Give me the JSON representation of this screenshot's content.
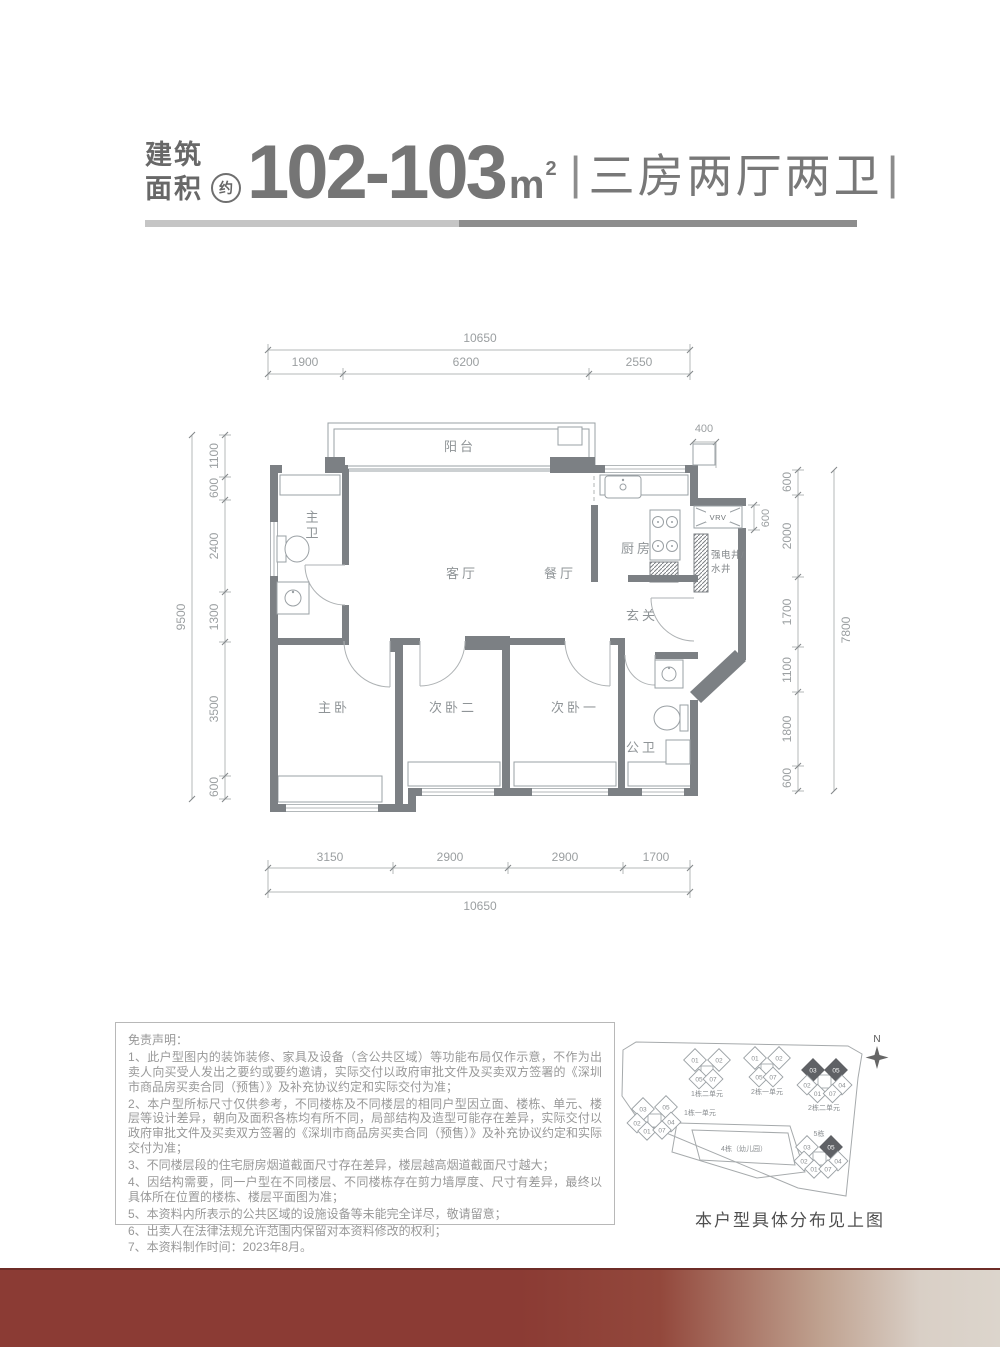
{
  "colors": {
    "accent_maroon": "#8b3b34",
    "footer_fade": "#d9cfc6",
    "wall_gray": "#7c8084",
    "line_gray": "#9aa0a4"
  },
  "header": {
    "area_label_top": "建筑",
    "area_label_bottom": "面积",
    "approx_badge": "约",
    "area_value": "102-103",
    "area_unit": "m",
    "area_exponent": "2",
    "bar_left": "|",
    "layout_spec": "三房两厅两卫",
    "bar_right": "|"
  },
  "floorplan": {
    "rooms": {
      "balcony": "阳台",
      "master_bath": "主卫",
      "living": "客厅",
      "dining": "餐厅",
      "kitchen": "厨房",
      "foyer": "玄关",
      "shaft_line1": "强电井/",
      "shaft_line2": "水井",
      "vrv": "VRV",
      "master_bed": "主卧",
      "bed2": "次卧二",
      "bed1": "次卧一",
      "bath2": "公卫"
    },
    "dims": {
      "top_total": "10650",
      "top": [
        "1900",
        "6200",
        "2550"
      ],
      "left_total": "9500",
      "left": [
        "1100",
        "600",
        "2400",
        "1300",
        "3500",
        "600"
      ],
      "right_total": "7800",
      "right": [
        "600",
        "2000",
        "1700",
        "1100",
        "1800",
        "600"
      ],
      "right_offset": "400",
      "vrv_offset": "600",
      "bottom": [
        "3150",
        "2900",
        "2900",
        "1700"
      ],
      "bottom_total": "10650"
    }
  },
  "disclaimer": {
    "title": "免责声明：",
    "items": [
      "1、此户型图内的装饰装修、家具及设备（含公共区域）等功能布局仅作示意，不作为出卖人向买受人发出之要约或要约邀请，实际交付以政府审批文件及买卖双方签署的《深圳市商品房买卖合同（预售）》及补充协议约定和实际交付为准；",
      "2、本户型所标尺寸仅供参考，不同楼栋及不同楼层的相同户型因立面、楼栋、单元、楼层等设计差异，朝向及面积各栋均有所不同，局部结构及造型可能存在差异，实际交付以政府审批文件及买卖双方签署的《深圳市商品房买卖合同（预售）》及补充协议约定和实际交付为准；",
      "3、不同楼层段的住宅厨房烟道截面尺寸存在差异，楼层越高烟道截面尺寸越大；",
      "4、因结构需要，同一户型在不同楼层、不同楼栋存在剪力墙厚度、尺寸有差异，最终以具体所在位置的楼栋、楼层平面图为准；",
      "5、本资料内所表示的公共区域的设施设备等未能完全详尽，敬请留意；",
      "6、出卖人在法律法规允许范围内保留对本资料修改的权利；",
      "7、本资料制作时间：2023年8月。"
    ]
  },
  "siteplan": {
    "north_label": "N",
    "caption": "本户型具体分布见上图",
    "building4_label": "4栋（幼儿园）",
    "clusters": [
      {
        "label": "1栋二单元",
        "units": [
          "01",
          "02",
          "05",
          "07"
        ]
      },
      {
        "label": "2栋一单元",
        "units": [
          "01",
          "02",
          "05",
          "07"
        ]
      },
      {
        "label": "2栋二单元",
        "units": [
          "03",
          "05",
          "02",
          "04",
          "01",
          "07"
        ],
        "highlighted": [
          "03",
          "05"
        ]
      },
      {
        "label": "1栋一单元",
        "units": [
          "03",
          "05",
          "02",
          "04",
          "01",
          "07"
        ]
      },
      {
        "label": "5栋",
        "units": [
          "03",
          "05",
          "02",
          "04",
          "01",
          "07"
        ],
        "highlighted": [
          "05"
        ]
      }
    ]
  }
}
